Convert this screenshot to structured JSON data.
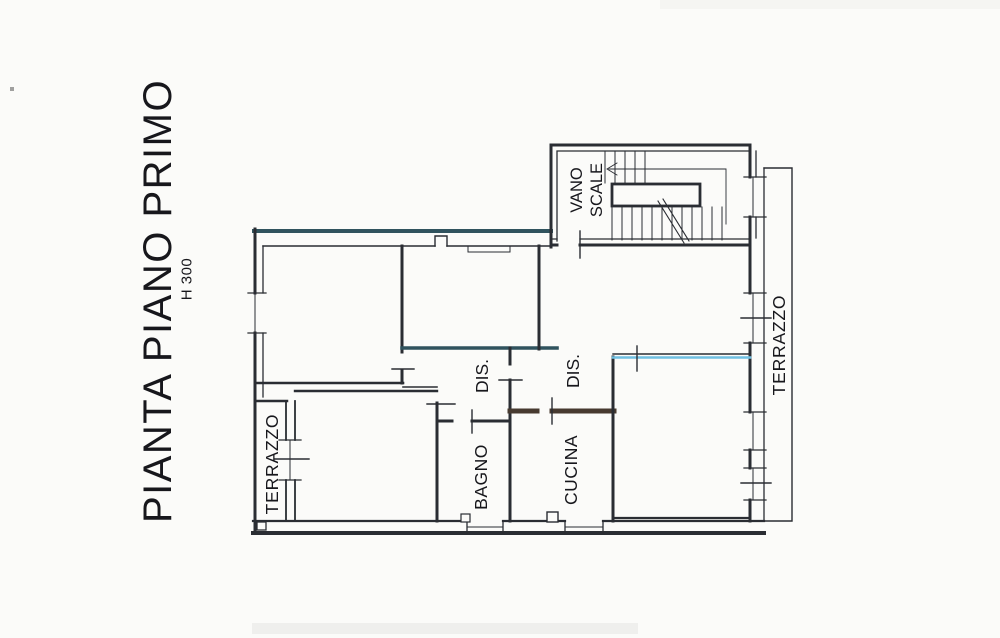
{
  "document": {
    "title": "PIANTA PIANO PRIMO",
    "height_note": "H 300"
  },
  "plan": {
    "labels": {
      "vano_scale_line1": "VANO",
      "vano_scale_line2": "SCALE",
      "terrazzo_right": "TERRAZZO",
      "terrazzo_left": "TERRAZZO",
      "dis_left": "DIS.",
      "dis_right": "DIS.",
      "bagno": "BAGNO",
      "cucina": "CUCINA"
    },
    "colors": {
      "ink": "#2a2d33",
      "teal_wall": "#30535e",
      "blue_wall": "#6fc0e2",
      "dark_wall": "#473a30",
      "paper": "#fbfbf9"
    }
  }
}
